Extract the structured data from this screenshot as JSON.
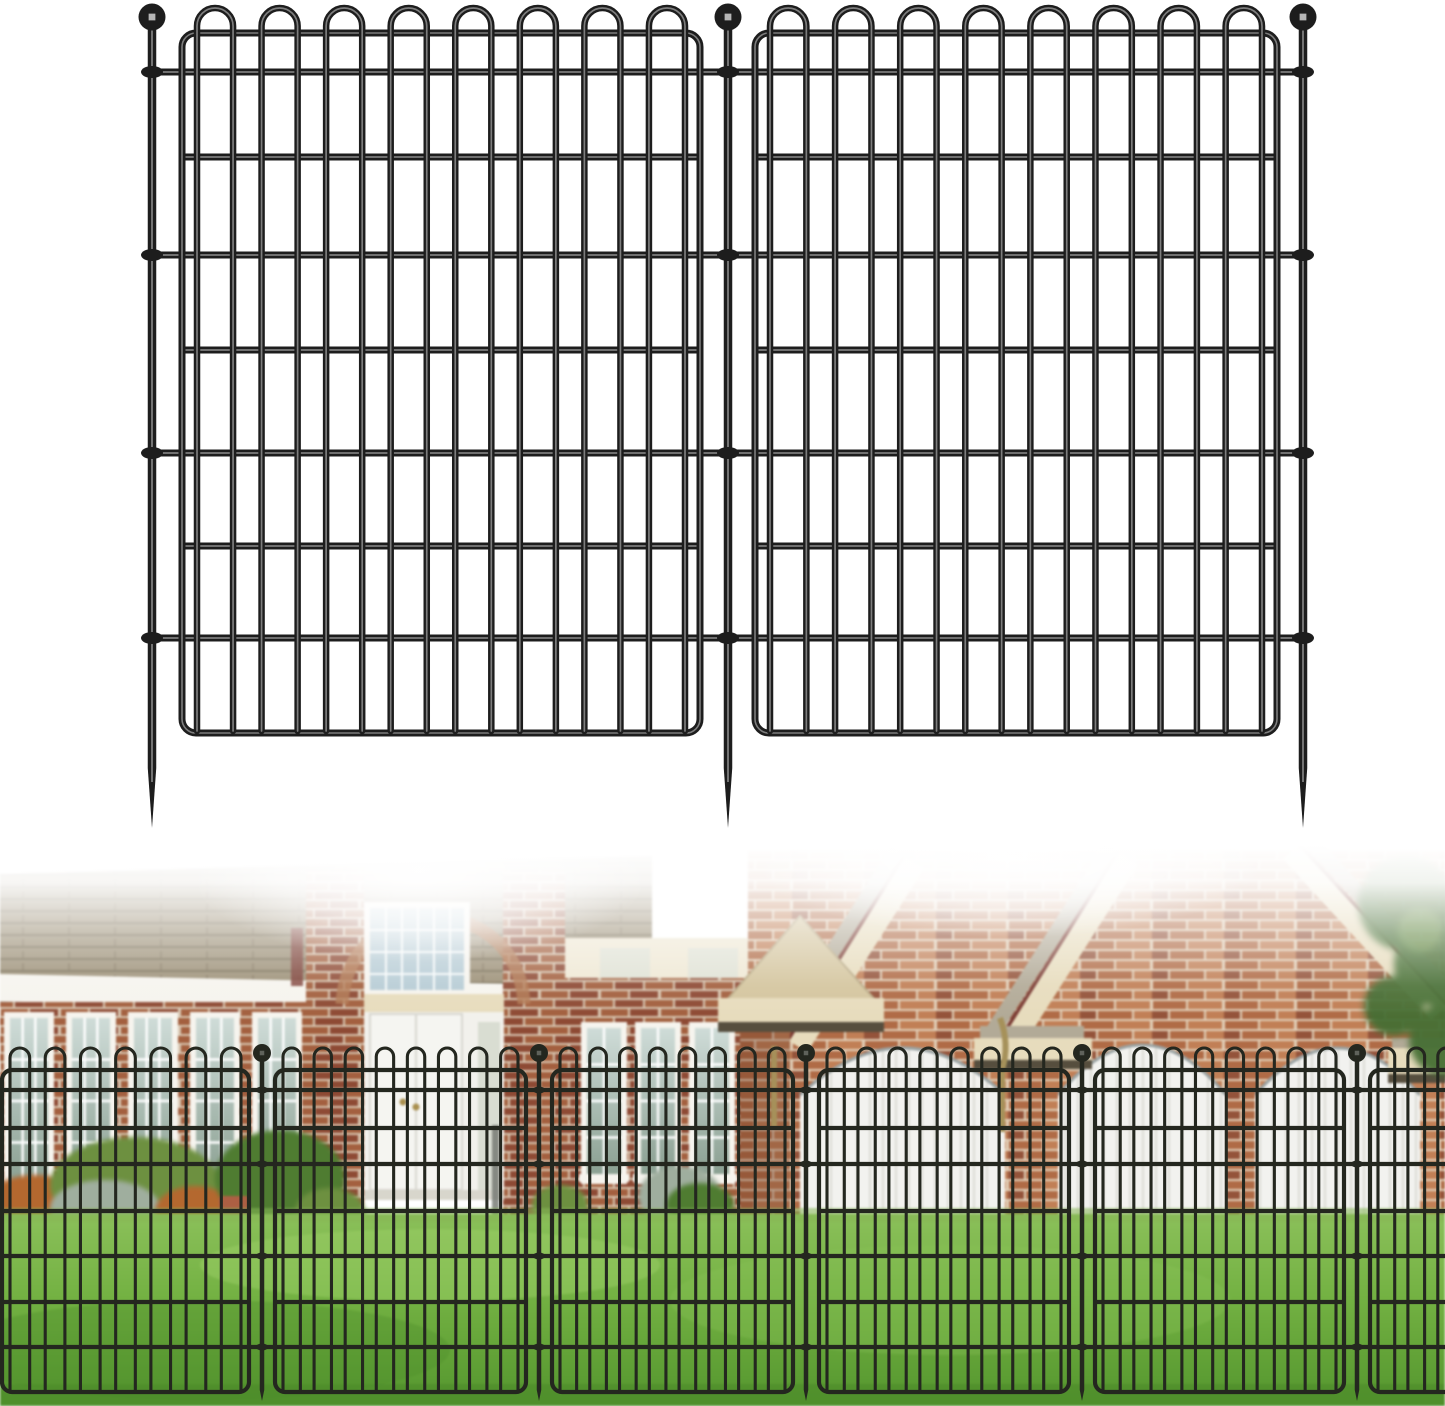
{
  "image_kind": "fence-product-listing-image",
  "product_summary": {
    "illustration_panels": 2,
    "illustration_stakes": 3,
    "loops_per_panel": 8,
    "horizontal_full_rails_per_panel": 4,
    "horizontal_inner_rails_per_panel": 3,
    "photo_stakes_visible": 5,
    "photo_panels_visible": 6
  },
  "palette": {
    "white": "#ffffff",
    "fence_ink": "#1d1d1d",
    "fence_ink_highlight": "#7d7d7d",
    "fence_photo_ink": "#24271f",
    "ball_glint": "#d0d0d0",
    "roof_shingle": "#9c9077",
    "roof_shingle_line": "#70654f",
    "fascia_white": "#f6f4ee",
    "fascia_shadow": "#8f8d80",
    "brick_left": "#a3603f",
    "brick_left_dark": "#8e4a34",
    "mortar_left": "#d8c7b2",
    "brick_gable": "#b06b46",
    "brick_gable_light": "#c17f56",
    "brick_gable_dark": "#94533a",
    "mortar_gable": "#e2d1ba",
    "cream_trim": "#e7dcbd",
    "trim_edge_red": "#7b3c34",
    "portico_face": "#d4c59e",
    "portico_under": "#564e3e",
    "roof_gray": "#b2aa97",
    "glass_light": "#cfdcd8",
    "glass_dark": "#8ba092",
    "entry_glass": "#b7ccd5",
    "door_white": "#f5f5f1",
    "utility_door": "#d9ddd2",
    "door_knob": "#a98f4e",
    "garage_door": "#f2f2ef",
    "garage_seam": "#dcdbd5",
    "garage_arch_trim": "#9aa3a3",
    "downspout_brass": "#a6915a",
    "downspout_gray": "#70746e",
    "lawn_light": "#8bc05a",
    "lawn_mid": "#74b243",
    "lawn_dark": "#54962e",
    "bush_green": "#6d9040",
    "bush_green_dark": "#4f7c31",
    "bush_orange": "#b4682f",
    "rock_gray": "#9fae9e",
    "pot_terracotta": "#ad5f43",
    "tree_green": "#466f34"
  },
  "illustration_fence": {
    "stakes": [
      152,
      728,
      1303
    ],
    "ball_cy": 17,
    "ball_r": 13.5,
    "stake_w": 8.5,
    "taper_start_y": 768,
    "tip_y": 828,
    "panels": [
      {
        "x1": 182,
        "x2": 700,
        "loops": 8
      },
      {
        "x1": 755,
        "x2": 1277,
        "loops": 8
      }
    ],
    "frame_top": 33,
    "frame_bottom": 733,
    "corner_r": 14,
    "margin": 15,
    "loop_apex": 8,
    "loop_gap_ratio": 0.79,
    "full_rails": [
      72,
      255,
      453,
      638
    ],
    "inner_rails": [
      157,
      350,
      546
    ],
    "wire_w": 6.5,
    "rail_w": 7,
    "frame_w": 7,
    "clamp_rx": 11,
    "clamp_ry": 6,
    "highlight": true
  },
  "photo_fence": {
    "stakes": [
      262,
      539,
      806,
      1082,
      1357
    ],
    "ball_cy": 1053,
    "ball_r": 9,
    "stake_w": 4.5,
    "taper_start_y": 1390,
    "tip_y": 1401,
    "panels": [
      {
        "x1": 2,
        "x2": 249,
        "loops": 7
      },
      {
        "x1": 275,
        "x2": 526,
        "loops": 8
      },
      {
        "x1": 552,
        "x2": 793,
        "loops": 8
      },
      {
        "x1": 819,
        "x2": 1069,
        "loops": 8
      },
      {
        "x1": 1095,
        "x2": 1344,
        "loops": 8
      },
      {
        "x1": 1370,
        "x2": 1612,
        "loops": 8
      }
    ],
    "frame_top": 1070,
    "frame_bottom": 1392,
    "corner_r": 10,
    "margin": 8,
    "loop_apex": 1048,
    "loop_gap_ratio": 0.79,
    "full_rails": [
      1090,
      1164,
      1256,
      1347
    ],
    "inner_rails": [
      1128,
      1211,
      1302
    ],
    "wire_w": 3.1,
    "rail_w": 4.2,
    "frame_w": 4.2,
    "clamp_rx": 6,
    "clamp_ry": 3.5,
    "highlight": false
  },
  "photo_scene": {
    "left_windows": {
      "y": 1012,
      "h": 182,
      "w": 50,
      "xs": [
        4,
        66,
        128,
        190,
        252
      ]
    },
    "mid_windows": {
      "y": 1022,
      "h": 162,
      "w": 46,
      "xs": [
        581,
        635,
        689
      ]
    },
    "faint_upper_windows": {
      "y": 948,
      "h": 40,
      "w": 50,
      "xs": [
        600,
        688
      ]
    },
    "garage_doors": [
      {
        "x": 800,
        "w": 205,
        "apex": 1048
      },
      {
        "x": 1058,
        "w": 168,
        "apex": 1045
      },
      {
        "x": 1255,
        "w": 165,
        "apex": 1048
      }
    ],
    "bushes": [
      {
        "cx": 35,
        "cy": 1210,
        "rx": 55,
        "ry": 35,
        "c": "bush_orange"
      },
      {
        "cx": 135,
        "cy": 1185,
        "rx": 85,
        "ry": 48,
        "c": "bush_green"
      },
      {
        "cx": 105,
        "cy": 1208,
        "rx": 55,
        "ry": 28,
        "c": "rock_gray"
      },
      {
        "cx": 195,
        "cy": 1212,
        "rx": 40,
        "ry": 26,
        "c": "bush_orange"
      },
      {
        "cx": 280,
        "cy": 1178,
        "rx": 65,
        "ry": 48,
        "c": "bush_green_dark"
      },
      {
        "cx": 330,
        "cy": 1212,
        "rx": 35,
        "ry": 24,
        "c": "bush_green"
      },
      {
        "cx": 560,
        "cy": 1205,
        "rx": 28,
        "ry": 20,
        "c": "bush_green"
      },
      {
        "cx": 680,
        "cy": 1196,
        "rx": 42,
        "ry": 30,
        "c": "rock_gray"
      },
      {
        "cx": 700,
        "cy": 1205,
        "rx": 34,
        "ry": 22,
        "c": "bush_green_dark"
      }
    ]
  }
}
